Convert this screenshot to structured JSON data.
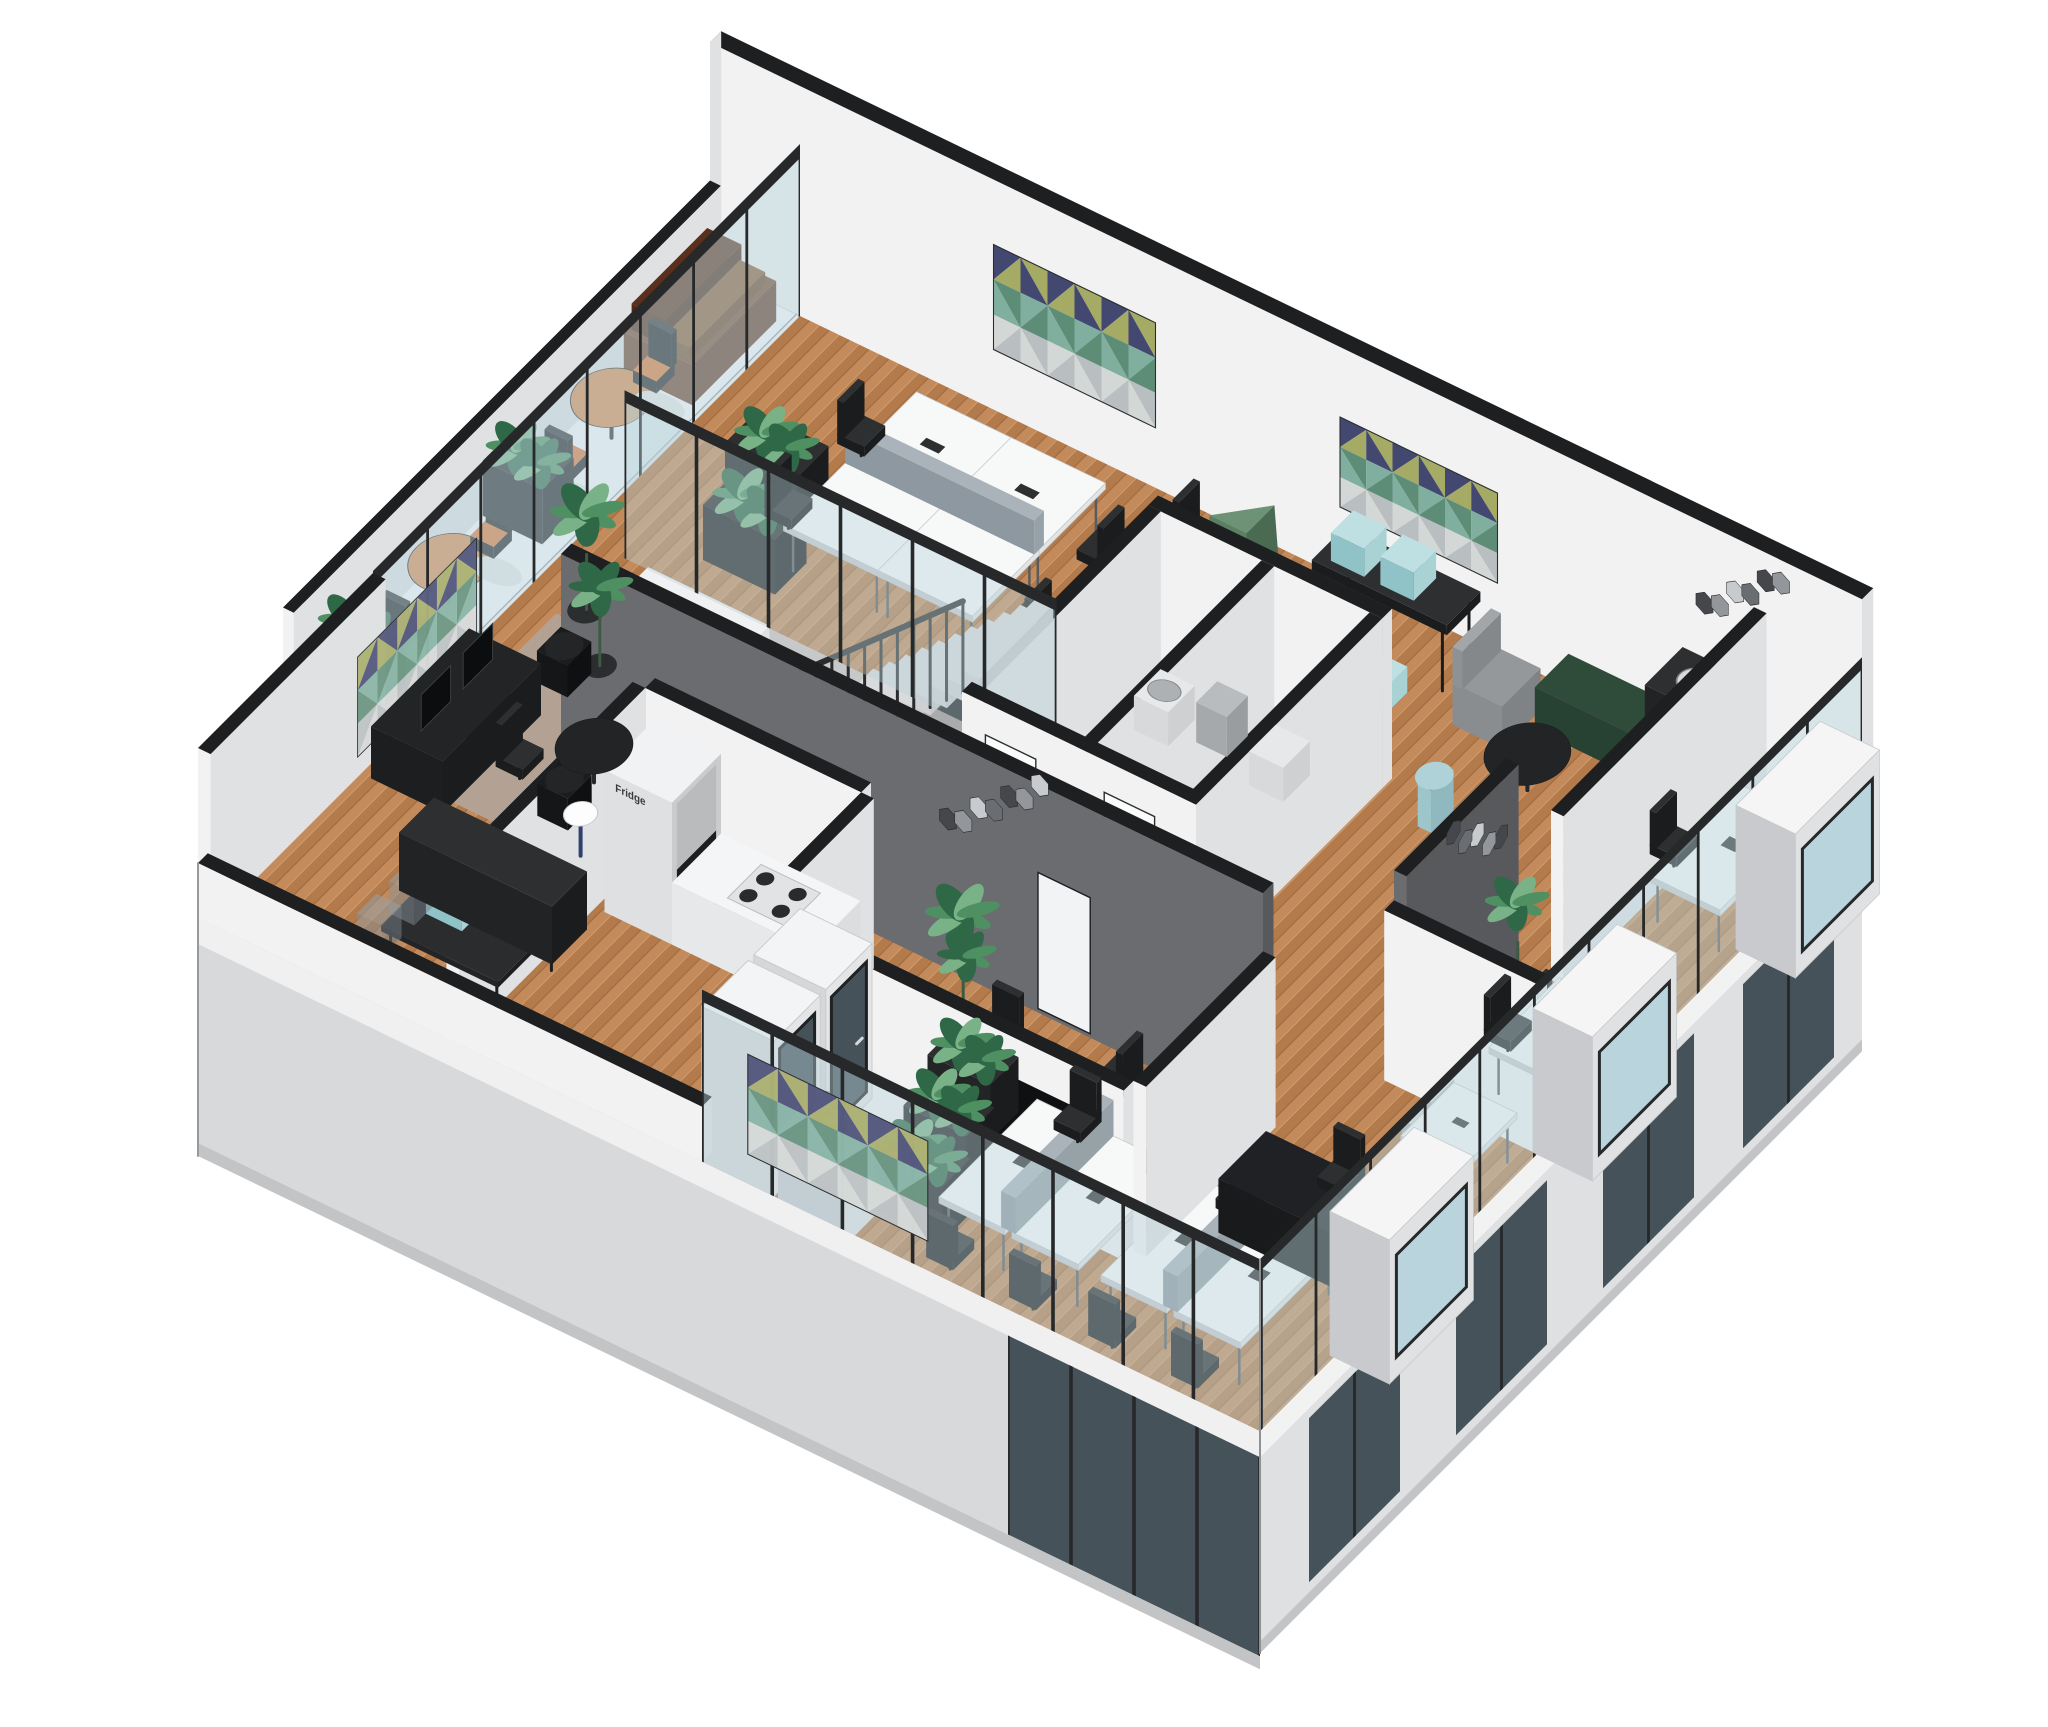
{
  "scene": {
    "kind": "isometric-cutaway-floorplan",
    "subject": "office floor interior axonometric rendering"
  },
  "labels": {
    "fridge": "Fridge"
  },
  "palette": {
    "background": "#ffffff",
    "wall_cap": "#1e1f21",
    "wall_light": "#f2f2f3",
    "wall_mid": "#e0e1e3",
    "wall_shadow": "#c9cacd",
    "wall_dark_face": "#6a6c70",
    "wall_dark_side": "#57595d",
    "exterior_wall": "#d8d9db",
    "exterior_shadow": "#c3c4c6",
    "floor_wood": "#c38b5c",
    "floor_wood_stripe": "#b37a4b",
    "floor_gray": "#c7c8ca",
    "stair_tread": "#d9dadc",
    "stair_side": "#c6c7c9",
    "glass": "#b9d4dc",
    "glass_dark": "#46525a",
    "mullion": "#26282a",
    "furn_black": "#1b1c1e",
    "furn_black2": "#2e2f31",
    "desk_white": "#f7f8f8",
    "desk_side": "#e3e4e6",
    "divider": "#a9b3b9",
    "plant_dark": "#2f6847",
    "plant_mid": "#4f9063",
    "plant_light": "#7ab287",
    "orange": "#d8894c",
    "orange_cushion": "#df7434",
    "sofa_wood": "#77452a",
    "sofa_cushion": "#5a2f1b",
    "rug_lounge": "#b3a294",
    "rug_meeting": "#c9c0b4",
    "crate_blue": "#a9d2d5",
    "screen_navy": "#434871",
    "screen_green": "#5e8d77",
    "screen_olive": "#a5aa65",
    "screen_light": "#d3d7d5",
    "screen_teal": "#80afa0",
    "green_object": "#5a7f63",
    "daybed_green": "#2e4c39",
    "chrome": "#b9bcbf",
    "pouf_blue": "#aed2d7",
    "armchair_gray": "#95989b",
    "shadow": "#e7e8e9"
  }
}
